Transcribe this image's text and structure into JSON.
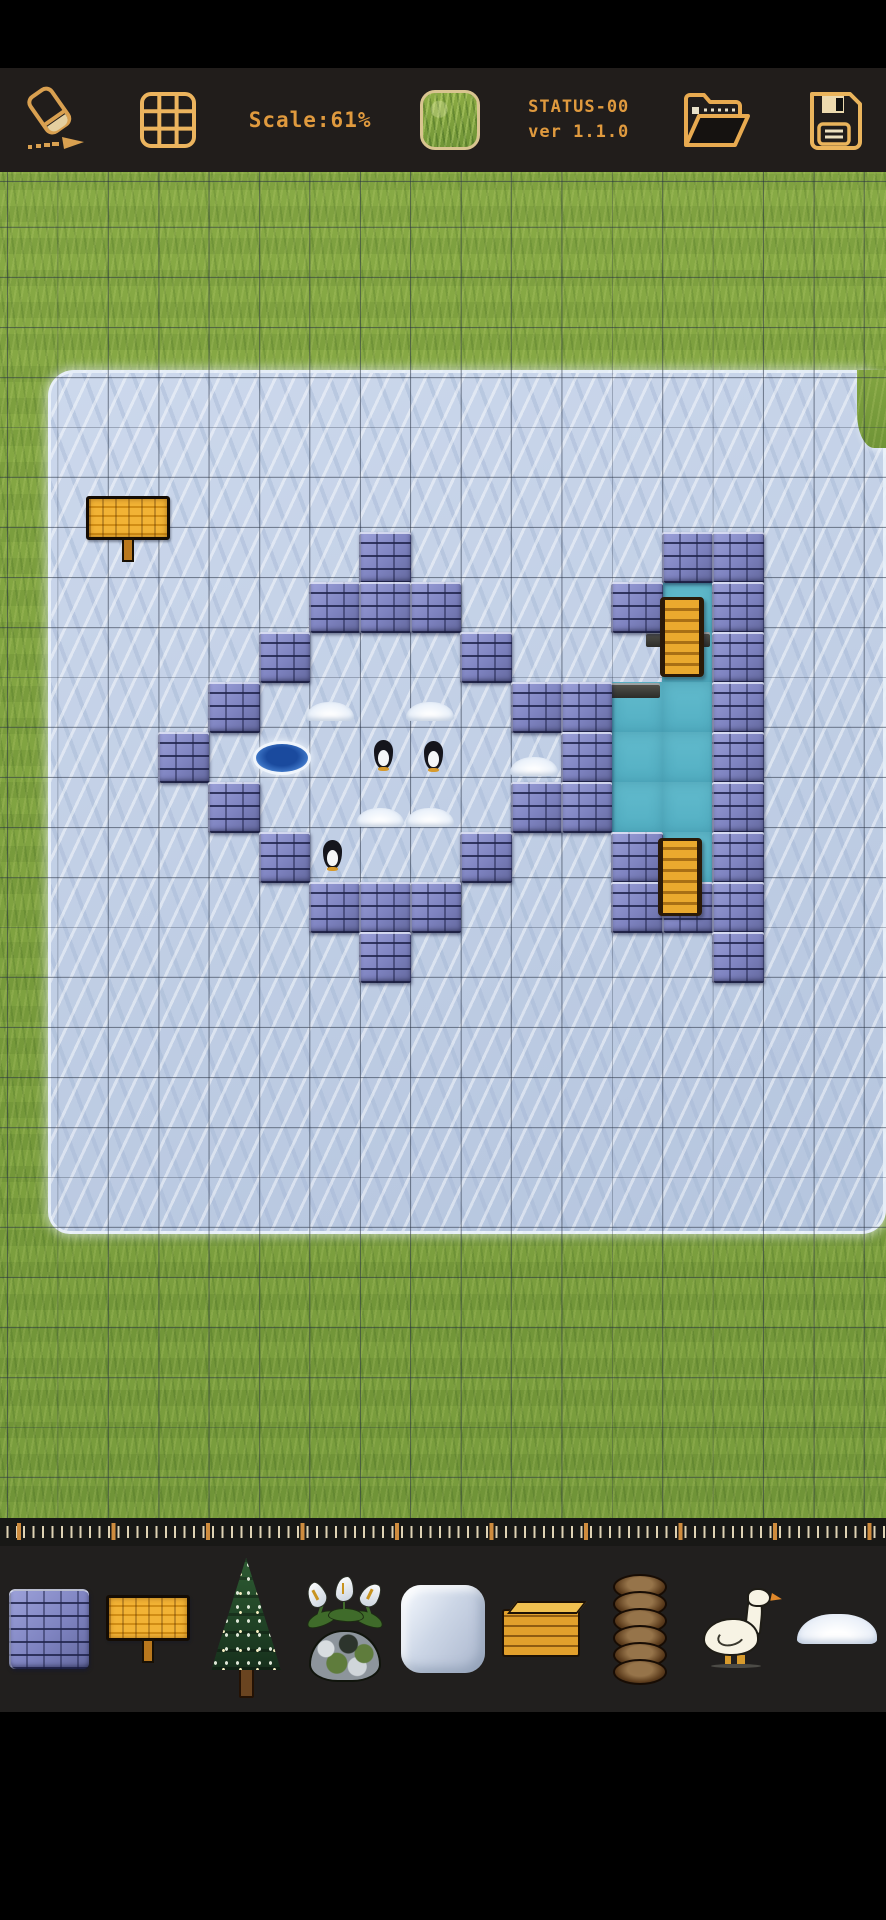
{
  "toolbar": {
    "scale_label": "Scale:61%",
    "status_line1": "STATUS-00",
    "status_line2": "ver 1.1.0",
    "accent_color": "#e09a3e",
    "icon_color": "#d9a050",
    "icons": [
      "eraser-icon",
      "grid-icon",
      "tile-preview",
      "open-folder-icon",
      "save-icon"
    ],
    "selected_tile": "grass"
  },
  "map": {
    "grid": {
      "tile_w": 50.4,
      "tile_h": 50,
      "offset_x": 7,
      "offset_y": 10,
      "line_color": "rgba(38,48,66,0.55)"
    },
    "terrain": {
      "base": "grass",
      "ice_rect": {
        "x": 48,
        "y": 198,
        "w": 838,
        "h": 864
      },
      "grass_patch_top_right": {
        "x": 857,
        "y": 198,
        "w": 29,
        "h": 78
      }
    },
    "bricks": [
      [
        7,
        7
      ],
      [
        13,
        7
      ],
      [
        14,
        7
      ],
      [
        6,
        8
      ],
      [
        7,
        8
      ],
      [
        8,
        8
      ],
      [
        12,
        8
      ],
      [
        14,
        8
      ],
      [
        5,
        9
      ],
      [
        9,
        9
      ],
      [
        14,
        9
      ],
      [
        4,
        10
      ],
      [
        10,
        10
      ],
      [
        11,
        10
      ],
      [
        14,
        10
      ],
      [
        3,
        11
      ],
      [
        11,
        11
      ],
      [
        14,
        11
      ],
      [
        4,
        12
      ],
      [
        10,
        12
      ],
      [
        11,
        12
      ],
      [
        14,
        12
      ],
      [
        5,
        13
      ],
      [
        9,
        13
      ],
      [
        12,
        13
      ],
      [
        14,
        13
      ],
      [
        6,
        14
      ],
      [
        7,
        14
      ],
      [
        8,
        14
      ],
      [
        12,
        14
      ],
      [
        13,
        14
      ],
      [
        14,
        14
      ],
      [
        7,
        15
      ],
      [
        14,
        15
      ]
    ],
    "water": [
      [
        13,
        8
      ],
      [
        13,
        9
      ],
      [
        13,
        10
      ],
      [
        13,
        11
      ],
      [
        13,
        12
      ],
      [
        13,
        13
      ],
      [
        12,
        10
      ],
      [
        12,
        11
      ],
      [
        12,
        12
      ]
    ],
    "ledges": [
      {
        "x": 646,
        "y": 460,
        "w": 64,
        "h": 15
      },
      {
        "x": 610,
        "y": 511,
        "w": 50,
        "h": 15
      },
      {
        "x": 646,
        "y": 678,
        "w": 16,
        "h": 13
      }
    ],
    "ramps": [
      {
        "x": 660,
        "y": 425,
        "w": 44,
        "h": 80
      },
      {
        "x": 658,
        "y": 666,
        "w": 44,
        "h": 78
      }
    ],
    "sign": {
      "x": 86,
      "y": 324
    },
    "ice_hole": {
      "x": 256,
      "y": 572
    },
    "penguins": [
      {
        "x": 374,
        "y": 568
      },
      {
        "x": 424,
        "y": 569
      },
      {
        "x": 323,
        "y": 668
      }
    ],
    "snow_mounds": [
      {
        "x": 306,
        "y": 530
      },
      {
        "x": 406,
        "y": 530
      },
      {
        "x": 356,
        "y": 636
      },
      {
        "x": 406,
        "y": 636
      },
      {
        "x": 510,
        "y": 585
      }
    ],
    "colors": {
      "grass": "#7ca03c",
      "ice": "#c3d1e6",
      "brick": "#7e83c0",
      "water": "#5bb7c9",
      "wood": "#e2a02c"
    }
  },
  "ruler": {
    "minor_spacing": 9.45,
    "major_spacing": 94.5,
    "minor_color": "#ded2b4",
    "major_color": "#cf8c3e"
  },
  "palette": {
    "items": [
      {
        "name": "brick-tile"
      },
      {
        "name": "wooden-sign"
      },
      {
        "name": "pine-tree"
      },
      {
        "name": "flower-plant"
      },
      {
        "name": "ice-tile"
      },
      {
        "name": "plank-stack"
      },
      {
        "name": "coil-stack"
      },
      {
        "name": "goose"
      },
      {
        "name": "snow-pile"
      }
    ]
  }
}
